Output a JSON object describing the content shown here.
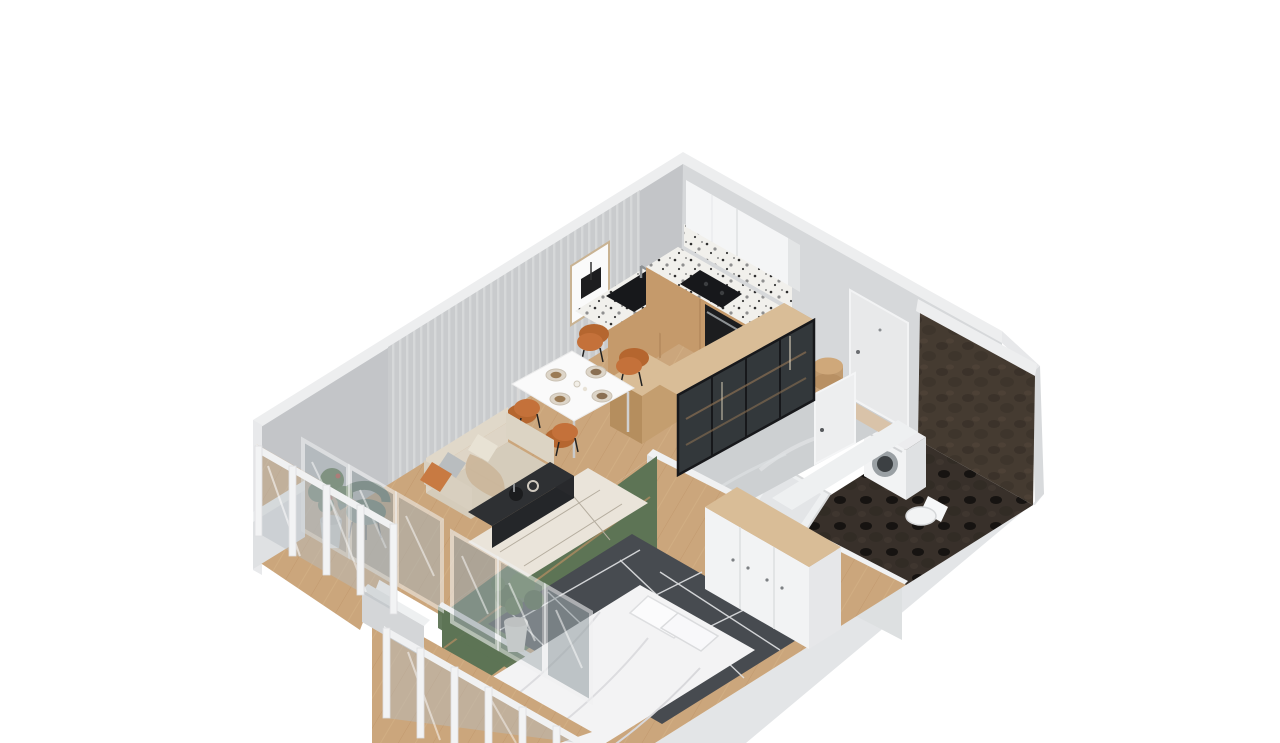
{
  "meta": {
    "type": "isometric-3d-floorplan-render",
    "subject": "one-bedroom apartment cutaway 3D floor plan",
    "visible_text": "none"
  },
  "palette": {
    "background": "#ffffff",
    "wallTop": "#edeeef",
    "wallFaceLeft": "#c3c5c8",
    "wallFaceRight": "#d6d8da",
    "wallFaceOuterBand": "#e3e5e7",
    "wallFaceOuterSide": "#d8dadc",
    "wallStub": "#d4d6d8",
    "ribbedPanel": "#c9cbcd",
    "woodFloor": "#cba67c",
    "woodPlankLine": "#b98e62",
    "woodCabinet": "#c59a6b",
    "woodTop": "#d9bd97",
    "woodDark": "#b08a58",
    "terrazzo": "#f1f0ec",
    "applianceBlack": "#17181b",
    "ovenBlack": "#1c1d1f",
    "upperCabinetWhite": "#f4f5f6",
    "doorWhite": "#eceded",
    "sofaBody": "#d5ccbb",
    "sofaBack": "#ded5c6",
    "pillowOrange": "#c87a42",
    "throwTan": "#cbb69b",
    "diningTable": "#fafafa",
    "chairOrange": "#c4713a",
    "chairOrangeDark": "#b5662f",
    "coffeeTable": "#2e3033",
    "rugCream": "#eae4da",
    "rugDark": "#474b50",
    "rugLinePattern": "#e2e3e5",
    "greenWall": "#5d7455",
    "greenChair": "#667d6c",
    "plantGreen": "#46603c",
    "plantGreenLight": "#5a7a4c",
    "flowerRed": "#b53a2e",
    "stoneWall": "#453b31",
    "stoneFloor": "#38302a",
    "hallFloor": "#cdd0d2",
    "fixtureWhite": "#f2f3f4",
    "bedWhite": "#f3f3f4",
    "glass": "#a9b2b6",
    "railWhite": "#f0f1f2"
  },
  "rooms": [
    {
      "name": "living-room",
      "objects": [
        "ribbed accent wall",
        "framed picture",
        "beige sofa",
        "orange pillow",
        "gray pillow",
        "tan throw blanket",
        "black coffee table",
        "decor vases",
        "cream rug with line pattern"
      ]
    },
    {
      "name": "dining-area",
      "objects": [
        "white dining table",
        "4 place settings",
        "4 orange chairs"
      ]
    },
    {
      "name": "kitchen",
      "objects": [
        "white upper cabinets",
        "terrazzo countertop L",
        "black sink with faucet",
        "black cooktop",
        "built-in oven",
        "wood base cabinets",
        "wood peninsula block"
      ]
    },
    {
      "name": "entry-hall",
      "objects": [
        "entrance door",
        "marble floor",
        "glass display cabinet with wood top",
        "round wooden pouf",
        "wall shelf",
        "door mat"
      ]
    },
    {
      "name": "bathroom",
      "objects": [
        "dark stone walls",
        "dark stone floor",
        "washing machine",
        "toilet",
        "bathtub",
        "bathroom door"
      ]
    },
    {
      "name": "bedroom",
      "objects": [
        "green accent wall",
        "dark gray rug with white geometric lines",
        "double bed with white bedding",
        "pillows",
        "potted plant",
        "white wardrobe with wood top",
        "closet unit",
        "bedroom door",
        "decor bottles"
      ]
    },
    {
      "name": "balcony-living",
      "objects": [
        "glass balustrade",
        "green armchair",
        "potted plant with red flowers",
        "sliding glass doors"
      ]
    },
    {
      "name": "balcony-bedroom",
      "objects": [
        "glass balustrade",
        "glass doors",
        "wood deck"
      ]
    }
  ],
  "counts": {
    "dining_chairs": 4,
    "plates": 4,
    "balcony_glass_panels_left": 4,
    "bedroom_window_panels": 3
  }
}
